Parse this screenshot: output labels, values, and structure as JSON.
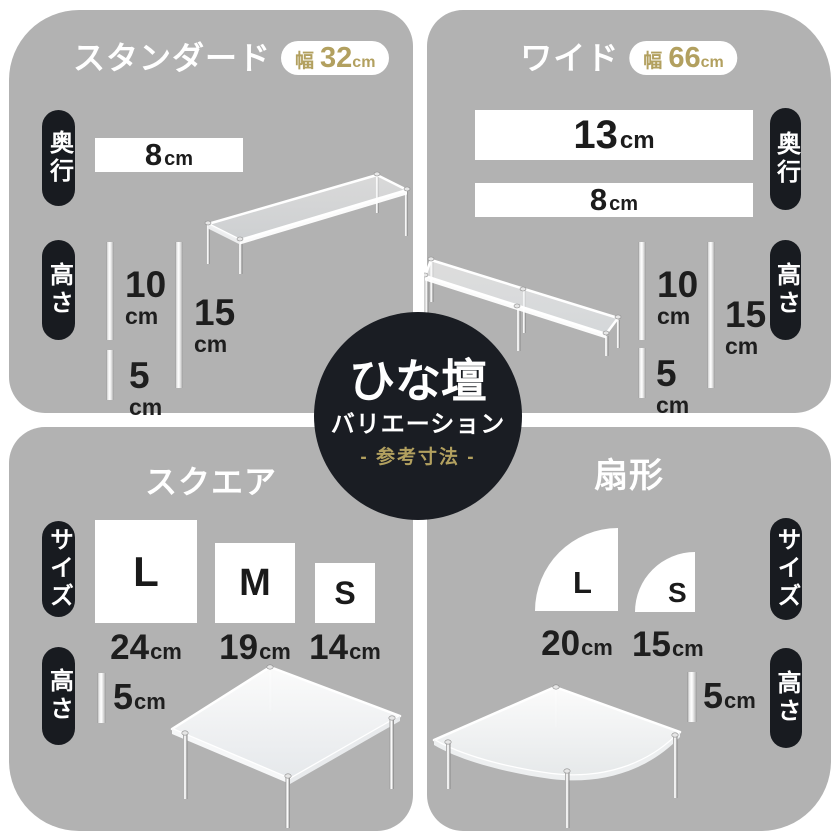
{
  "colors": {
    "panel_gray": "#b2b2b2",
    "pill_black": "#181b20",
    "circle_black": "#1a1d23",
    "gold_accent": "#b2a05f",
    "dimension_text": "#1c1c1c"
  },
  "center": {
    "title": "ひな壇",
    "subtitle": "バリエーション",
    "note": "- 参考寸法 -"
  },
  "panels": {
    "standard": {
      "title": "スタンダード",
      "badge": {
        "label": "幅",
        "value": "32",
        "unit": "cm"
      },
      "depth_label": "奥行",
      "depth": {
        "value": "8",
        "unit": "cm"
      },
      "height_label": "高さ",
      "heights": [
        {
          "value": "10",
          "unit": "cm"
        },
        {
          "value": "15",
          "unit": "cm"
        },
        {
          "value": "5",
          "unit": "cm"
        }
      ]
    },
    "wide": {
      "title": "ワイド",
      "badge": {
        "label": "幅",
        "value": "66",
        "unit": "cm"
      },
      "depth_label": "奥行",
      "depths": [
        {
          "value": "13",
          "unit": "cm"
        },
        {
          "value": "8",
          "unit": "cm"
        }
      ],
      "height_label": "高さ",
      "heights": [
        {
          "value": "10",
          "unit": "cm"
        },
        {
          "value": "15",
          "unit": "cm"
        },
        {
          "value": "5",
          "unit": "cm"
        }
      ]
    },
    "square": {
      "title": "スクエア",
      "size_label": "サイズ",
      "sizes": [
        {
          "label": "L",
          "value": "24",
          "unit": "cm"
        },
        {
          "label": "M",
          "value": "19",
          "unit": "cm"
        },
        {
          "label": "S",
          "value": "14",
          "unit": "cm"
        }
      ],
      "height_label": "高さ",
      "height": {
        "value": "5",
        "unit": "cm"
      }
    },
    "fan": {
      "title": "扇形",
      "size_label": "サイズ",
      "sizes": [
        {
          "label": "L",
          "value": "20",
          "unit": "cm"
        },
        {
          "label": "S",
          "value": "15",
          "unit": "cm"
        }
      ],
      "height_label": "高さ",
      "height": {
        "value": "5",
        "unit": "cm"
      }
    }
  }
}
